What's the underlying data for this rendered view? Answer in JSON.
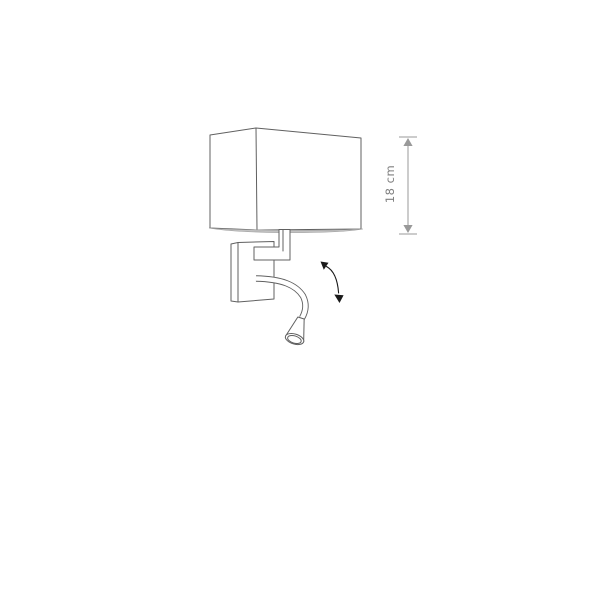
{
  "diagram": {
    "type": "product-technical-drawing",
    "subject": "wall lamp with rectangular shade and flexible LED reading arm",
    "dimension_label": "18 cm",
    "colors": {
      "background": "#ffffff",
      "line": "#606060",
      "dimension": "#999999",
      "dimension_text": "#808080",
      "rim_fill": "#c2c2c2",
      "motion_arrow": "#1a1a1a"
    },
    "icons": [
      "height-dimension-arrow",
      "rotation-arrow"
    ],
    "parts": [
      "lampshade",
      "wall-mount-plate",
      "support-arm",
      "flexible-gooseneck",
      "reading-light-head"
    ]
  }
}
